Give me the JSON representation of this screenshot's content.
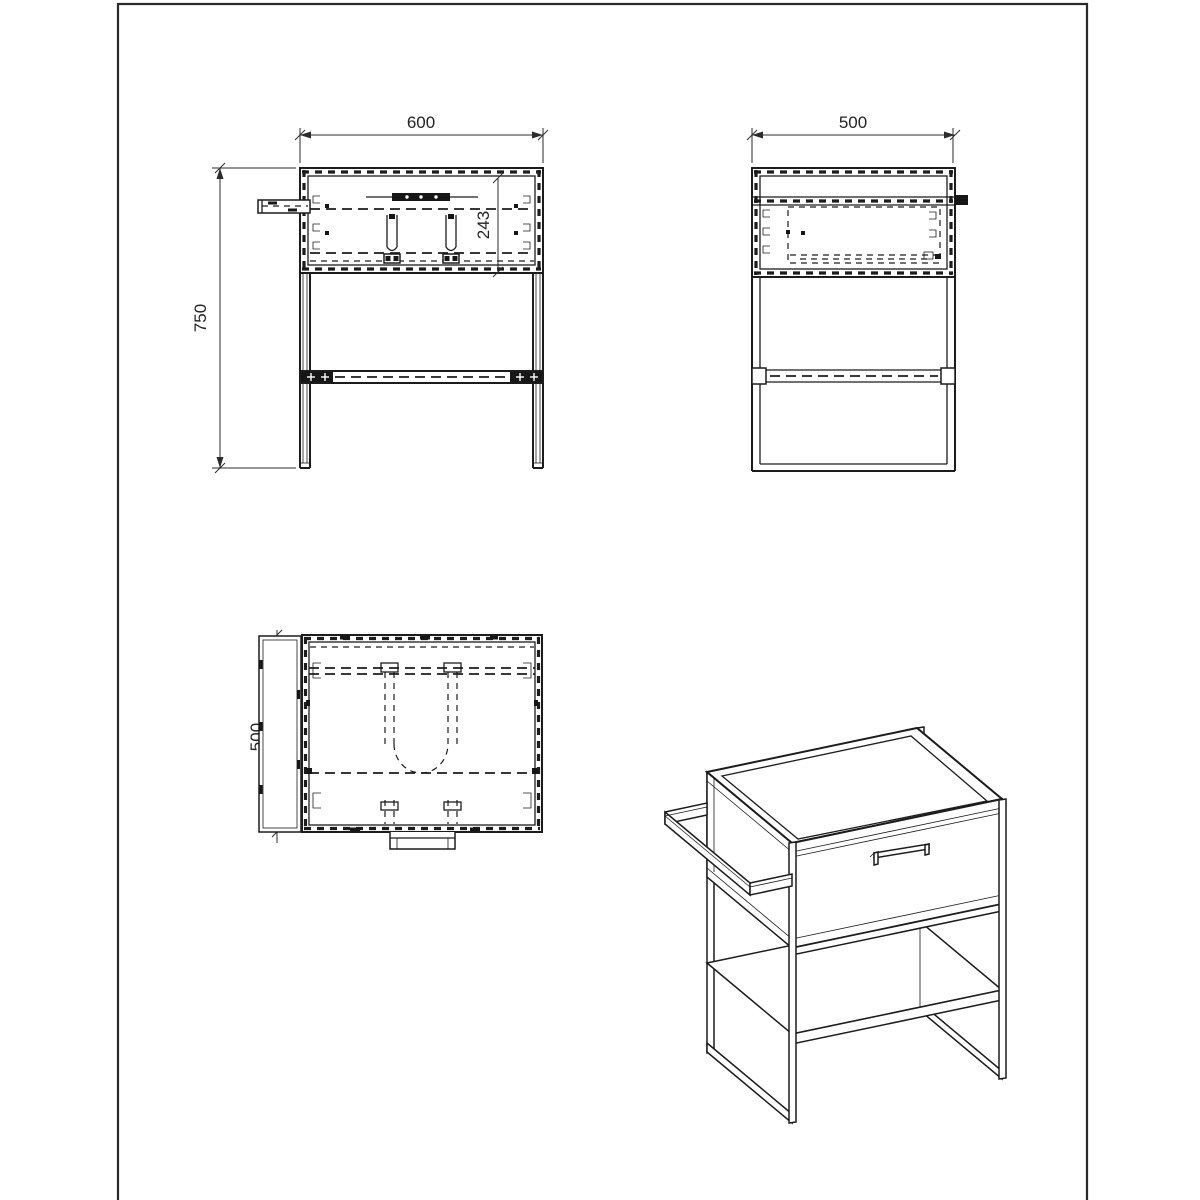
{
  "page": {
    "background": "#ffffff",
    "line_color": "#1c1c1c",
    "dim_color": "#2b2b2b"
  },
  "drawing": {
    "type": "furniture-technical-drawing",
    "views": [
      "front",
      "side",
      "plan",
      "isometric"
    ],
    "dimensions": {
      "front_width": "600",
      "front_height": "750",
      "front_drawer_height": "243",
      "side_depth": "500",
      "plan_depth": "500"
    }
  }
}
